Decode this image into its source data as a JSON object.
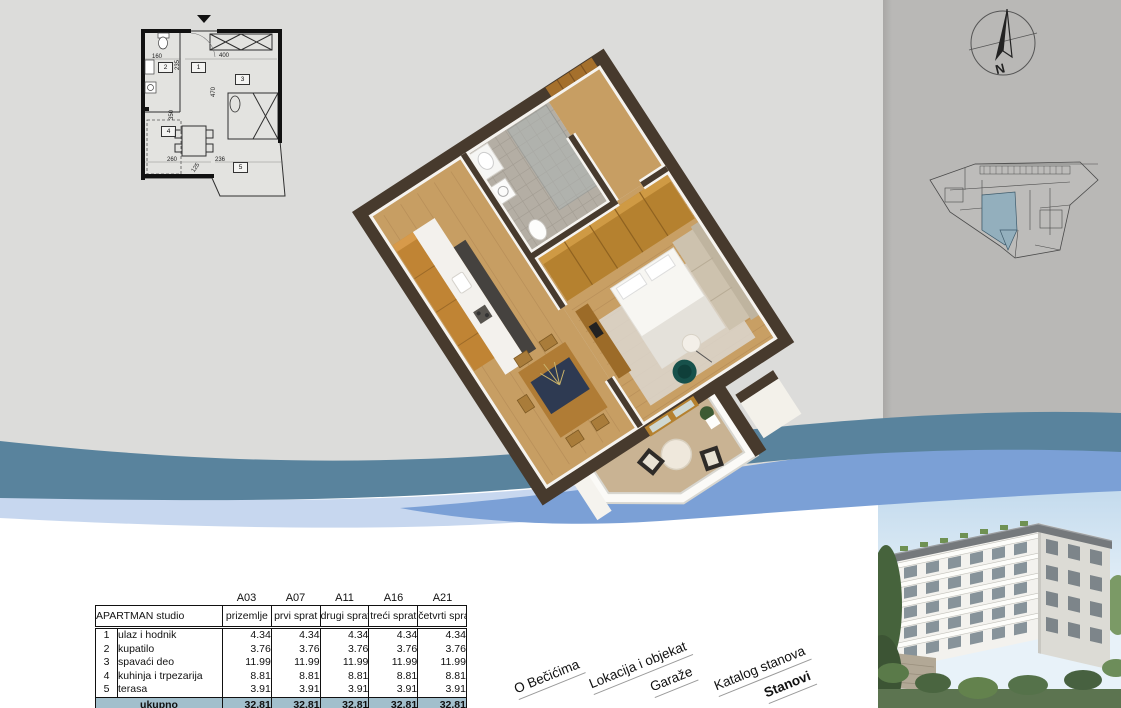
{
  "nav": {
    "items": [
      {
        "label": "O Bečićima",
        "active": false
      },
      {
        "label": "Lokacija i objekat",
        "active": false
      },
      {
        "label": "Garaže",
        "active": false
      },
      {
        "label": "Katalog stanova",
        "active": false
      },
      {
        "label": "Stanovi",
        "active": true
      }
    ]
  },
  "area_table": {
    "unit_codes": [
      "A03",
      "A07",
      "A11",
      "A16",
      "A21"
    ],
    "apartment_label": "APARTMAN studio",
    "floor_labels": [
      "prizemlje",
      "prvi sprat",
      "drugi sprat",
      "treći sprat",
      "četvrti sprat"
    ],
    "rows": [
      {
        "num": "1",
        "name": "ulaz i hodnik",
        "values": [
          "4.34",
          "4.34",
          "4.34",
          "4.34",
          "4.34"
        ]
      },
      {
        "num": "2",
        "name": "kupatilo",
        "values": [
          "3.76",
          "3.76",
          "3.76",
          "3.76",
          "3.76"
        ]
      },
      {
        "num": "3",
        "name": "spavaći deo",
        "values": [
          "11.99",
          "11.99",
          "11.99",
          "11.99",
          "11.99"
        ]
      },
      {
        "num": "4",
        "name": "kuhinja i trpezarija",
        "values": [
          "8.81",
          "8.81",
          "8.81",
          "8.81",
          "8.81"
        ]
      },
      {
        "num": "5",
        "name": "terasa",
        "values": [
          "3.91",
          "3.91",
          "3.91",
          "3.91",
          "3.91"
        ]
      }
    ],
    "total_label": "ukupno",
    "total_values": [
      "32.81",
      "32.81",
      "32.81",
      "32.81",
      "32.81"
    ]
  },
  "floor_plan": {
    "dimensions": [
      "160",
      "235",
      "400",
      "470",
      "350",
      "260",
      "236",
      "125"
    ],
    "room_numbers": [
      "1",
      "2",
      "3",
      "4",
      "5"
    ]
  },
  "compass": {
    "north_label": "N"
  },
  "colors": {
    "background_left": "#dcdcda",
    "background_right": "#b9b8b6",
    "wave_teal": "#59839d",
    "wave_blue": "#7ba0d6",
    "wave_light_blue": "#c7d7ef",
    "table_total_bg": "#a2bfcc",
    "site_plan_highlight": "#93afbd"
  }
}
